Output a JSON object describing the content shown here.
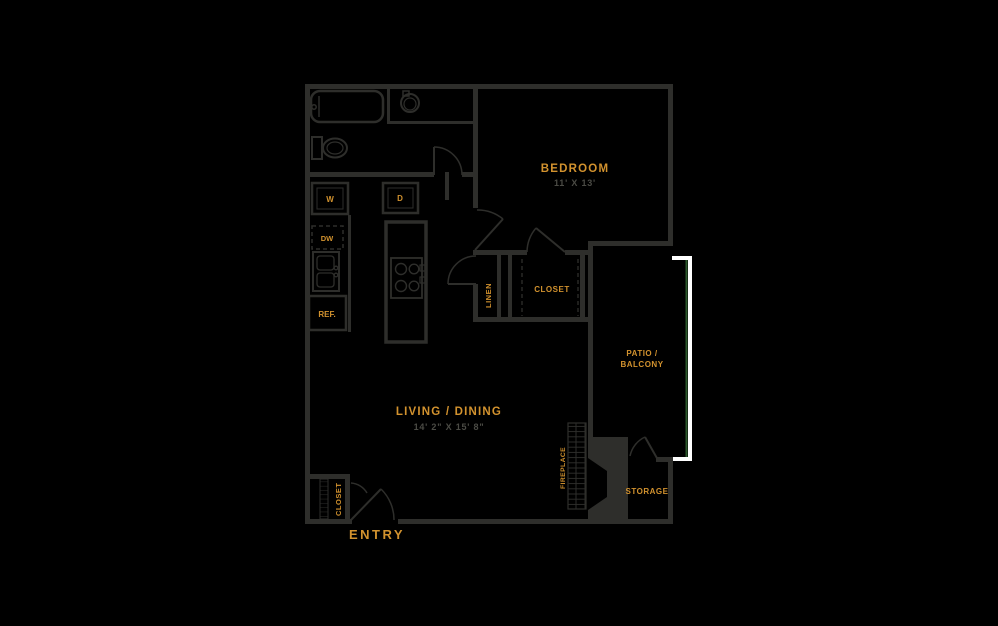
{
  "colors": {
    "background": "#000000",
    "wall": "#2e2e2b",
    "label": "#d2922e",
    "dims": "#4b4b45",
    "railing": "#ffffff",
    "railing_accent": "#2d5a2d"
  },
  "floorplan": {
    "bedroom": {
      "label": "BEDROOM",
      "dims": "11' X 13'"
    },
    "living": {
      "label": "LIVING / DINING",
      "dims": "14' 2\" X 15' 8\""
    },
    "patio": {
      "label_line1": "PATIO /",
      "label_line2": "BALCONY"
    },
    "linen": {
      "label": "LINEN"
    },
    "closet": {
      "label": "CLOSET"
    },
    "entry_closet": {
      "label": "CLOSET"
    },
    "fireplace": {
      "label": "FIREPLACE"
    },
    "storage": {
      "label": "STORAGE"
    },
    "entry": {
      "label": "ENTRY"
    },
    "appliances": {
      "washer": "W",
      "dryer": "D",
      "dishwasher": "DW",
      "refrigerator": "REF."
    }
  }
}
